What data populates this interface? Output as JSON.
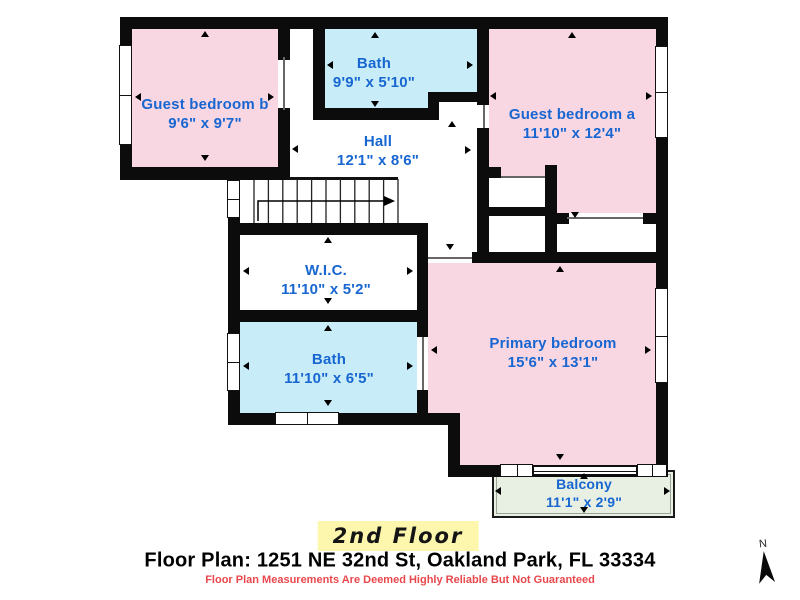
{
  "plan": {
    "floor_label": "2nd Floor",
    "rooms": [
      {
        "name": "Guest bedroom b",
        "dims": "9'6\" x 9'7\""
      },
      {
        "name": "Bath",
        "dims": "9'9\" x 5'10\""
      },
      {
        "name": "Guest bedroom a",
        "dims": "11'10\" x 12'4\""
      },
      {
        "name": "Hall",
        "dims": "12'1\" x 8'6\""
      },
      {
        "name": "W.I.C.",
        "dims": "11'10\" x 5'2\""
      },
      {
        "name": "Bath",
        "dims": "11'10\" x 6'5\""
      },
      {
        "name": "Primary bedroom",
        "dims": "15'6\" x 13'1\""
      },
      {
        "name": "Balcony",
        "dims": "11'1\" x 2'9\""
      }
    ]
  },
  "footer": {
    "address": "Floor Plan: 1251 NE 32nd St, Oakland Park, FL 33334",
    "disclaimer": "Floor Plan Measurements Are Deemed Highly Reliable But Not Guaranteed"
  },
  "compass": {
    "label": "N"
  },
  "colors": {
    "wall_black": "#0c0c0c",
    "bedroom_pink": "#f9d7e2",
    "bath_blue": "#c8edf8",
    "balcony_green": "#e7f0e3",
    "label_blue": "#1766d1",
    "disclaimer_red": "#e8484d",
    "highlight_yellow": "#fdf7ae"
  }
}
